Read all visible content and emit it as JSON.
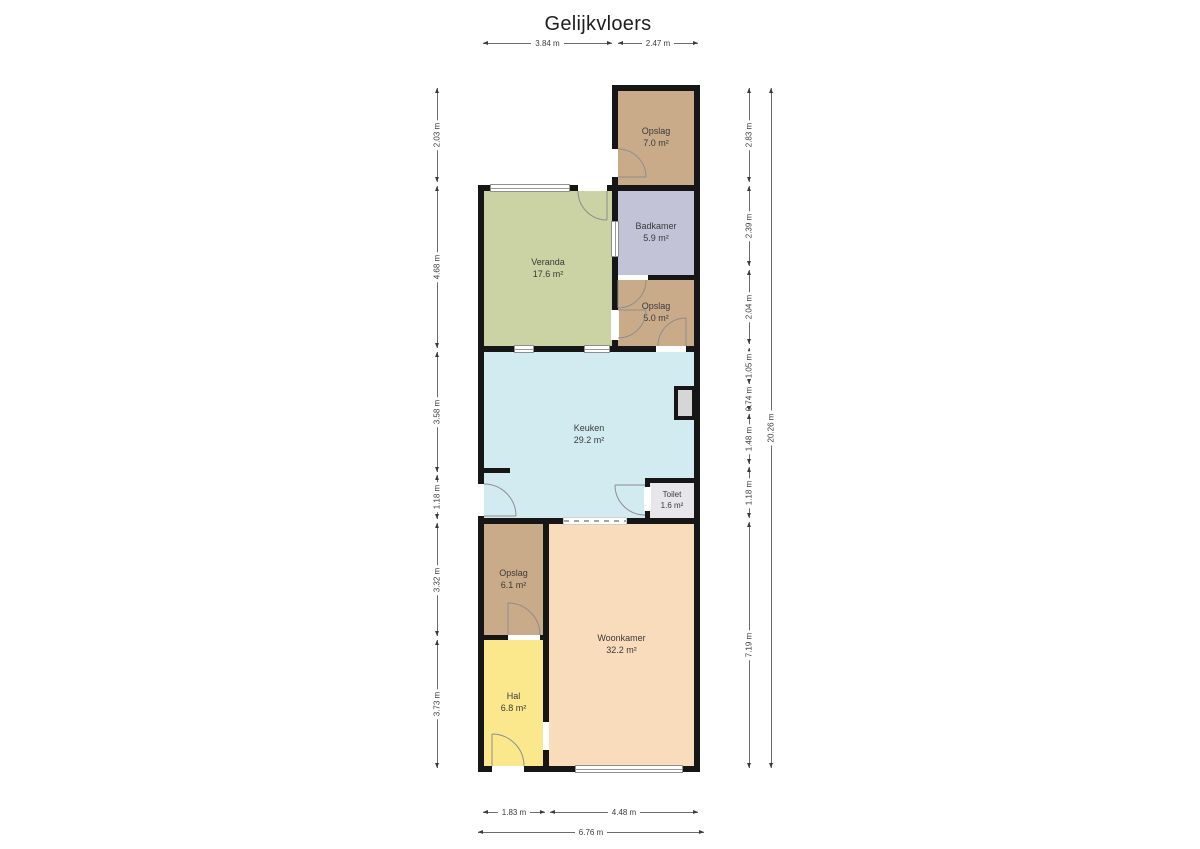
{
  "title": "Gelijkvloers",
  "rooms": [
    {
      "name": "Opslag",
      "area": "7.0 m²"
    },
    {
      "name": "Badkamer",
      "area": "5.9 m²"
    },
    {
      "name": "Veranda",
      "area": "17.6 m²"
    },
    {
      "name": "Opslag",
      "area": "5.0 m²"
    },
    {
      "name": "Keuken",
      "area": "29.2 m²"
    },
    {
      "name": "Toilet",
      "area": "1.6 m²"
    },
    {
      "name": "Opslag",
      "area": "6.1 m²"
    },
    {
      "name": "Hal",
      "area": "6.8 m²"
    },
    {
      "name": "Woonkamer",
      "area": "32.2 m²"
    }
  ],
  "dims": {
    "top": [
      "3.84 m",
      "2.47 m"
    ],
    "left": [
      "2.03 m",
      "4.68 m",
      "3.58 m",
      "1.18 m",
      "3.32 m",
      "3.73 m"
    ],
    "right": [
      "2.83 m",
      "2.39 m",
      "2.04 m",
      "1.05 m",
      "0.74 m",
      "1.48 m",
      "1.18 m",
      "7.19 m"
    ],
    "right_total": "20.26 m",
    "bottom": [
      "1.83 m",
      "4.48 m"
    ],
    "bottom_total": "6.76 m"
  },
  "colors": {
    "wall": "#161616",
    "opslag": "#c9ab8a",
    "badkamer": "#c3c3d8",
    "veranda": "#cbd3a4",
    "keuken": "#d2ebf1",
    "toilet": "#e7e7eb",
    "hal": "#fbe88c",
    "woonkamer": "#f8dcbb"
  }
}
